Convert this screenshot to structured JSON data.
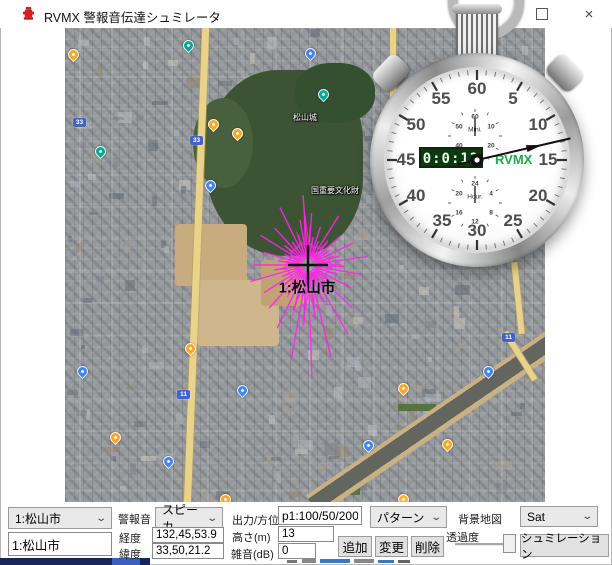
{
  "window": {
    "title": "RVMX 警報音伝達シュミレータ",
    "close_glyph": "×"
  },
  "map": {
    "city_label": "1:松山市",
    "labels": [
      {
        "text": "松山城",
        "x": 228,
        "y": 84
      },
      {
        "text": "国重要文化財",
        "x": 246,
        "y": 157
      }
    ],
    "pins": [
      {
        "x": 143,
        "y": 91,
        "color": "#f9a825"
      },
      {
        "x": 167,
        "y": 100,
        "color": "#f9a825"
      },
      {
        "x": 3,
        "y": 21,
        "color": "#f9a825"
      },
      {
        "x": 120,
        "y": 315,
        "color": "#f9a825"
      },
      {
        "x": 333,
        "y": 355,
        "color": "#f9a825"
      },
      {
        "x": 377,
        "y": 411,
        "color": "#f9a825"
      },
      {
        "x": 45,
        "y": 404,
        "color": "#f9a825"
      },
      {
        "x": 155,
        "y": 466,
        "color": "#f9a825"
      },
      {
        "x": 333,
        "y": 466,
        "color": "#f7b731"
      },
      {
        "x": 140,
        "y": 152,
        "color": "#4285f4"
      },
      {
        "x": 172,
        "y": 357,
        "color": "#4285f4"
      },
      {
        "x": 418,
        "y": 338,
        "color": "#4285f4"
      },
      {
        "x": 298,
        "y": 412,
        "color": "#4285f4"
      },
      {
        "x": 98,
        "y": 428,
        "color": "#4285f4"
      },
      {
        "x": 12,
        "y": 338,
        "color": "#4285f4"
      },
      {
        "x": 240,
        "y": 20,
        "color": "#4285f4"
      },
      {
        "x": 253,
        "y": 61,
        "color": "#00a896"
      },
      {
        "x": 118,
        "y": 12,
        "color": "#00a896"
      },
      {
        "x": 30,
        "y": 118,
        "color": "#00a896"
      }
    ],
    "shields": [
      {
        "num": "33",
        "x": 8,
        "y": 90
      },
      {
        "num": "33",
        "x": 125,
        "y": 108
      },
      {
        "num": "11",
        "x": 112,
        "y": 362
      },
      {
        "num": "11",
        "x": 437,
        "y": 305
      }
    ],
    "starburst": {
      "cx": 243,
      "cy": 237,
      "rays": [
        [
          356,
          70
        ],
        [
          4,
          52
        ],
        [
          10,
          28
        ],
        [
          18,
          40
        ],
        [
          24,
          26
        ],
        [
          32,
          58
        ],
        [
          40,
          30
        ],
        [
          48,
          44
        ],
        [
          56,
          26
        ],
        [
          64,
          50
        ],
        [
          74,
          32
        ],
        [
          82,
          60
        ],
        [
          92,
          36
        ],
        [
          100,
          55
        ],
        [
          108,
          30
        ],
        [
          118,
          48
        ],
        [
          126,
          28
        ],
        [
          134,
          62
        ],
        [
          144,
          34
        ],
        [
          150,
          80
        ],
        [
          158,
          40
        ],
        [
          166,
          95
        ],
        [
          172,
          55
        ],
        [
          178,
          112
        ],
        [
          184,
          60
        ],
        [
          190,
          96
        ],
        [
          198,
          48
        ],
        [
          206,
          70
        ],
        [
          214,
          36
        ],
        [
          222,
          58
        ],
        [
          230,
          30
        ],
        [
          238,
          52
        ],
        [
          246,
          28
        ],
        [
          254,
          60
        ],
        [
          262,
          34
        ],
        [
          270,
          55
        ],
        [
          278,
          30
        ],
        [
          286,
          46
        ],
        [
          294,
          26
        ],
        [
          302,
          56
        ],
        [
          310,
          30
        ],
        [
          318,
          50
        ],
        [
          326,
          28
        ],
        [
          334,
          64
        ],
        [
          342,
          32
        ],
        [
          350,
          46
        ]
      ]
    }
  },
  "stopwatch": {
    "lcd": "0:0:12",
    "brand": "RVMX",
    "brand_color": "#1ea94c",
    "dial_numbers": [
      "60",
      "5",
      "10",
      "15",
      "20",
      "25",
      "30",
      "35",
      "40",
      "45",
      "50",
      "55"
    ],
    "minute_dial": {
      "caption": "Mini.",
      "numbers": [
        "60",
        "10",
        "20",
        "30",
        "40",
        "50"
      ]
    },
    "hour_dial": {
      "caption": "Hour.",
      "numbers": [
        "24",
        "4",
        "8",
        "12",
        "16",
        "20"
      ]
    },
    "second_hand_deg": 77
  },
  "controls": {
    "area_select": "1:松山市",
    "area_input": "1:松山市",
    "alarm_label": "警報音",
    "alarm_select": "スピーカ",
    "longitude_label": "経度",
    "longitude_value": "132,45,53.9",
    "latitude_label": "緯度",
    "latitude_value": "33,50,21.2",
    "output_label": "出力/方位",
    "output_value": "p1:100/50/200",
    "height_label": "高さ(m)",
    "height_value": "13",
    "noise_label": "雑音(dB)",
    "noise_value": "0",
    "add_button": "追加",
    "change_button": "変更",
    "delete_button": "削除",
    "pattern_select": "パターン",
    "bgmap_label": "背景地図",
    "bgmap_select": "Sat",
    "opacity_label": "透過度",
    "simulate_button": "シュミレーション"
  }
}
